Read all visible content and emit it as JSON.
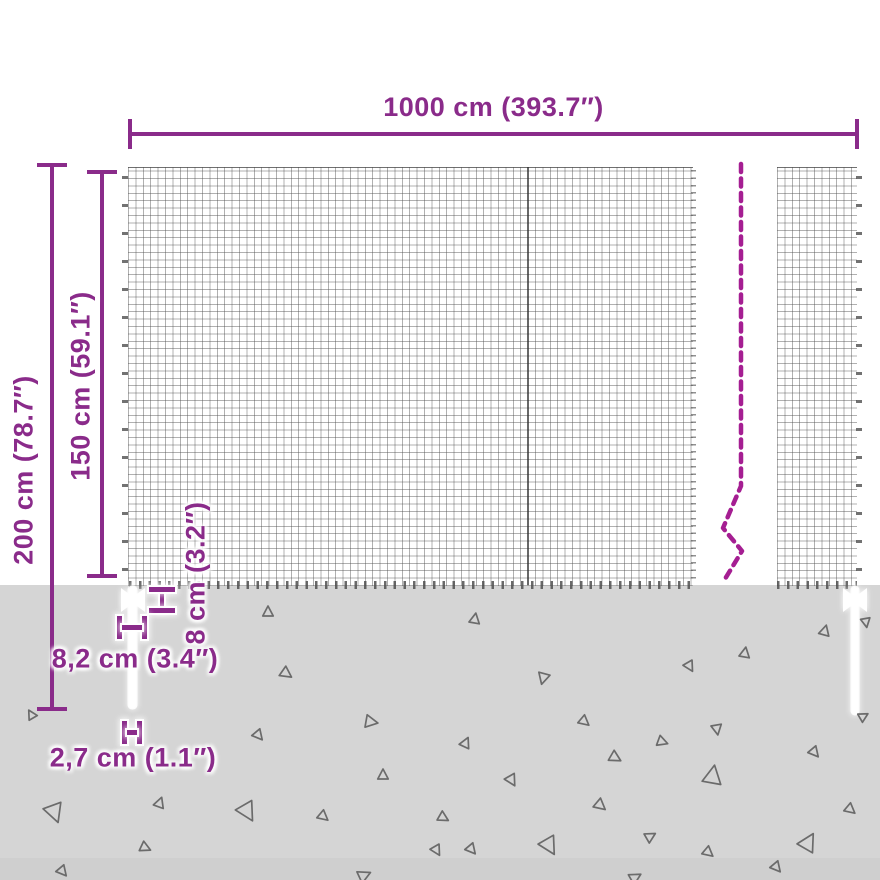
{
  "diagram": {
    "kind": "mesh-fence-dimension-diagram",
    "dimensions": {
      "total_width": "1000 cm (393.7″)",
      "total_height": "200 cm (78.7″)",
      "mesh_height": "150 cm (59.1″)",
      "anchor_height": "8 cm (3.2″)",
      "anchor_width": "8,2 cm (3.4″)",
      "post_width": "2,7 cm (1.1″)"
    },
    "colors": {
      "dimension_purple": "#8a2b8a",
      "break_line_magenta": "#a51e92",
      "ground_gray": "#d5d5d5",
      "mesh_line_gray": "#8a8a8a",
      "triangle_gray": "#6b6b6b",
      "post_white": "#ffffff"
    },
    "ground": {
      "triangles": [
        [
          31,
          714,
          9,
          -30
        ],
        [
          268,
          611,
          10,
          0
        ],
        [
          475,
          618,
          10,
          10
        ],
        [
          287,
          674,
          11,
          125
        ],
        [
          543,
          679,
          11,
          195
        ],
        [
          690,
          667,
          10,
          150
        ],
        [
          745,
          652,
          10,
          10
        ],
        [
          825,
          630,
          10,
          15
        ],
        [
          866,
          623,
          9,
          170
        ],
        [
          372,
          722,
          12,
          100
        ],
        [
          259,
          736,
          10,
          140
        ],
        [
          585,
          722,
          10,
          130
        ],
        [
          466,
          742,
          10,
          25
        ],
        [
          616,
          758,
          11,
          120
        ],
        [
          383,
          774,
          10,
          0
        ],
        [
          512,
          781,
          11,
          150
        ],
        [
          717,
          730,
          10,
          170
        ],
        [
          815,
          753,
          10,
          140
        ],
        [
          663,
          742,
          10,
          110
        ],
        [
          601,
          806,
          11,
          130
        ],
        [
          248,
          813,
          18,
          150
        ],
        [
          324,
          817,
          10,
          130
        ],
        [
          444,
          818,
          10,
          120
        ],
        [
          55,
          814,
          18,
          160
        ],
        [
          160,
          802,
          10,
          20
        ],
        [
          146,
          848,
          10,
          115
        ],
        [
          63,
          872,
          10,
          140
        ],
        [
          713,
          774,
          18,
          10
        ],
        [
          851,
          810,
          10,
          130
        ],
        [
          550,
          847,
          17,
          150
        ],
        [
          472,
          850,
          10,
          140
        ],
        [
          651,
          836,
          10,
          60
        ],
        [
          809,
          841,
          17,
          30
        ],
        [
          709,
          853,
          10,
          130
        ],
        [
          777,
          868,
          10,
          140
        ],
        [
          636,
          877,
          11,
          60
        ],
        [
          365,
          875,
          12,
          65
        ],
        [
          437,
          851,
          10,
          150
        ],
        [
          864,
          716,
          9,
          60
        ]
      ]
    }
  }
}
